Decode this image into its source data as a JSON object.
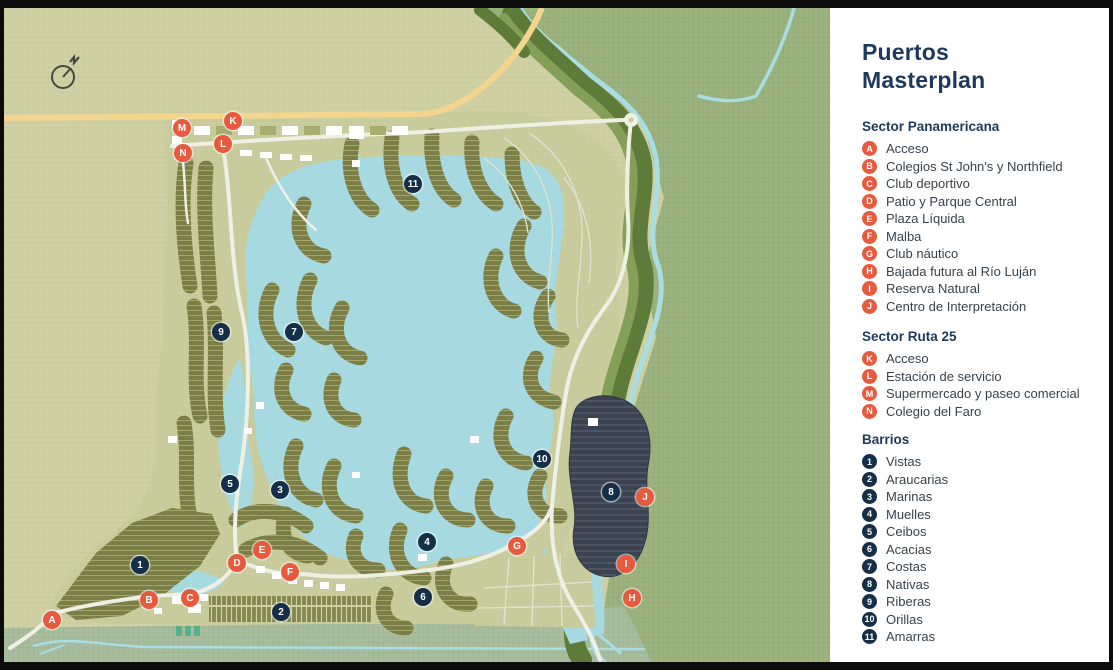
{
  "panel": {
    "title_line1": "Puertos",
    "title_line2": "Masterplan",
    "sections": [
      {
        "heading": "Sector Panamericana",
        "badge_style": "poi",
        "items": [
          {
            "badge": "A",
            "label": "Acceso"
          },
          {
            "badge": "B",
            "label": "Colegios St John's y Northfield"
          },
          {
            "badge": "C",
            "label": "Club deportivo"
          },
          {
            "badge": "D",
            "label": "Patio y Parque Central"
          },
          {
            "badge": "E",
            "label": "Plaza Líquida"
          },
          {
            "badge": "F",
            "label": "Malba"
          },
          {
            "badge": "G",
            "label": "Club náutico"
          },
          {
            "badge": "H",
            "label": "Bajada futura al Río Luján"
          },
          {
            "badge": "I",
            "label": "Reserva Natural"
          },
          {
            "badge": "J",
            "label": "Centro de Interpretación"
          }
        ]
      },
      {
        "heading": "Sector Ruta 25",
        "badge_style": "poi",
        "items": [
          {
            "badge": "K",
            "label": "Acceso"
          },
          {
            "badge": "L",
            "label": "Estación de servicio"
          },
          {
            "badge": "M",
            "label": "Supermercado y paseo comercial"
          },
          {
            "badge": "N",
            "label": "Colegio del Faro"
          }
        ]
      },
      {
        "heading": "Barrios",
        "badge_style": "barrio",
        "items": [
          {
            "badge": "1",
            "label": "Vistas"
          },
          {
            "badge": "2",
            "label": "Araucarias"
          },
          {
            "badge": "3",
            "label": "Marinas"
          },
          {
            "badge": "4",
            "label": "Muelles"
          },
          {
            "badge": "5",
            "label": "Ceibos"
          },
          {
            "badge": "6",
            "label": "Acacias"
          },
          {
            "badge": "7",
            "label": "Costas"
          },
          {
            "badge": "8",
            "label": "Nativas"
          },
          {
            "badge": "9",
            "label": "Riberas"
          },
          {
            "badge": "10",
            "label": "Orillas"
          },
          {
            "badge": "11",
            "label": "Amarras"
          }
        ]
      }
    ]
  },
  "map": {
    "compass_label": "N",
    "markers": [
      {
        "id": "A",
        "type": "poi",
        "x": 48,
        "y": 612
      },
      {
        "id": "B",
        "type": "poi",
        "x": 145,
        "y": 592
      },
      {
        "id": "C",
        "type": "poi",
        "x": 186,
        "y": 590
      },
      {
        "id": "D",
        "type": "poi",
        "x": 233,
        "y": 555
      },
      {
        "id": "E",
        "type": "poi",
        "x": 258,
        "y": 542
      },
      {
        "id": "F",
        "type": "poi",
        "x": 286,
        "y": 564
      },
      {
        "id": "G",
        "type": "poi",
        "x": 513,
        "y": 538
      },
      {
        "id": "H",
        "type": "poi",
        "x": 628,
        "y": 590
      },
      {
        "id": "I",
        "type": "poi",
        "x": 622,
        "y": 556
      },
      {
        "id": "J",
        "type": "poi",
        "x": 641,
        "y": 489
      },
      {
        "id": "K",
        "type": "poi",
        "x": 229,
        "y": 113
      },
      {
        "id": "L",
        "type": "poi",
        "x": 219,
        "y": 136
      },
      {
        "id": "M",
        "type": "poi",
        "x": 178,
        "y": 120
      },
      {
        "id": "N",
        "type": "poi",
        "x": 179,
        "y": 145
      },
      {
        "id": "1",
        "type": "barrio",
        "x": 136,
        "y": 557
      },
      {
        "id": "2",
        "type": "barrio",
        "x": 277,
        "y": 604
      },
      {
        "id": "3",
        "type": "barrio",
        "x": 276,
        "y": 482
      },
      {
        "id": "4",
        "type": "barrio",
        "x": 423,
        "y": 534
      },
      {
        "id": "5",
        "type": "barrio",
        "x": 226,
        "y": 476
      },
      {
        "id": "6",
        "type": "barrio",
        "x": 419,
        "y": 589
      },
      {
        "id": "7",
        "type": "barrio",
        "x": 290,
        "y": 324
      },
      {
        "id": "8",
        "type": "barrio",
        "x": 607,
        "y": 484
      },
      {
        "id": "9",
        "type": "barrio",
        "x": 217,
        "y": 324
      },
      {
        "id": "10",
        "type": "barrio",
        "x": 538,
        "y": 451
      },
      {
        "id": "11",
        "type": "barrio",
        "x": 409,
        "y": 176
      }
    ]
  },
  "colors": {
    "poi_badge": "#e85a3e",
    "barrio_badge": "#142f47",
    "title": "#1d3a5c",
    "land_tan": "#cfd1a5",
    "land_green": "#9cb27f",
    "water": "#a6dae0",
    "forest_ribbon": "#5e7b3a",
    "highway_yellow": "#f3d58d",
    "road_white": "#eef0e6",
    "cluster_olive": "#7c7e47",
    "cluster_dark": "#3a434f"
  }
}
